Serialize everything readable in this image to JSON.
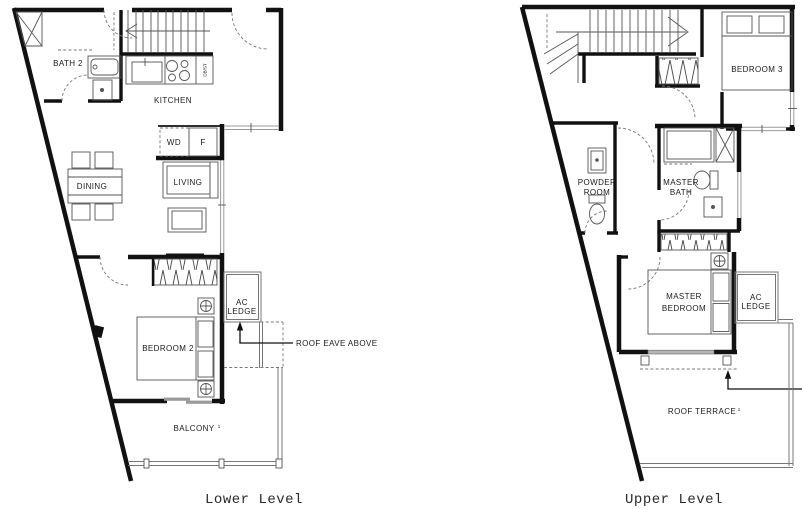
{
  "title": "Unit floor plan - lower and upper level",
  "colors": {
    "background": "#ffffff",
    "wall": "#111111",
    "thin_line": "#555555",
    "glass": "#999999",
    "dashed": "#777777",
    "text": "#1a1a1a",
    "caption": "#2a2a2a"
  },
  "lower_plan": {
    "caption": "Lower Level",
    "labels": {
      "bath2": "BATH 2",
      "kitchen": "KITCHEN",
      "db_st": "DB/ST",
      "wd": "WD",
      "fridge": "F",
      "dining": "DINING",
      "living": "LIVING",
      "bedroom2": "BEDROOM 2",
      "ac_line1": "AC",
      "ac_line2": "LEDGE",
      "balcony": "BALCONY",
      "balcony_note": "1",
      "roof_eave": "ROOF EAVE ABOVE"
    }
  },
  "upper_plan": {
    "caption": "Upper Level",
    "labels": {
      "bedroom3": "BEDROOM 3",
      "powder_line1": "POWDER",
      "powder_line2": "ROOM",
      "masterbath_line1": "MASTER",
      "masterbath_line2": "BATH",
      "masterbed_line1": "MASTER",
      "masterbed_line2": "BEDROOM",
      "ac_line1": "AC",
      "ac_line2": "LEDGE",
      "roof_terrace": "ROOF TERRACE",
      "roof_terrace_note": "1"
    }
  }
}
